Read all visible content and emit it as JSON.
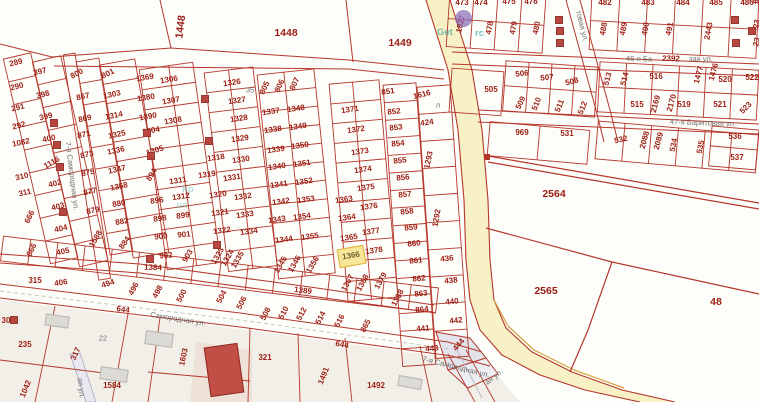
{
  "selected_parcel": {
    "label": "1366",
    "x": 338,
    "y": 247,
    "w": 25,
    "h": 17,
    "rot": -10
  },
  "colors": {
    "parcel_line": "#b5372b",
    "parcel_text": "#9c1d13",
    "street_text": "#707070",
    "road_fill": "#f8f1c6",
    "road_curb": "#d7a33c",
    "lower_area_fill": "#f2efe8",
    "highlight_fill": "#f8e79b",
    "highlight_border": "#dfae33",
    "building_fill": "#b8463e",
    "gray_building_fill": "#dcdad5",
    "gray_lot_fill": "#e3e4eb",
    "watermark_teal": "#209e9e",
    "watermark_purple": "#7b5ea7"
  },
  "watermark": {
    "left": "Get",
    "right": "rc",
    "mid1": "Кр",
    "mid2": "ол"
  },
  "streets": [
    [
      "7-я Самородная ул.",
      72,
      176,
      83
    ],
    [
      "Самородная ул.",
      178,
      319,
      9
    ],
    [
      "7-я Самородная ул.",
      456,
      367,
      14
    ],
    [
      "ая ул.",
      494,
      377,
      -38
    ],
    [
      "ая ул.",
      81,
      388,
      83
    ],
    [
      "товая ул.",
      582,
      26,
      76
    ],
    [
      "46-я Ба",
      639,
      59,
      1
    ],
    [
      "зая ул.",
      701,
      59,
      1
    ],
    [
      "47-я Баритовая ул.",
      703,
      123,
      2
    ],
    [
      "35",
      250,
      90,
      0
    ],
    [
      "л",
      438,
      105,
      0
    ],
    [
      "22",
      103,
      338,
      0
    ]
  ],
  "area_labels": [
    [
      "1448",
      181,
      27,
      -83
    ],
    [
      "1448",
      286,
      33,
      0
    ],
    [
      "1449",
      400,
      43,
      0
    ],
    [
      "2564",
      554,
      194,
      0
    ],
    [
      "2565",
      546,
      291,
      0
    ],
    [
      "48",
      716,
      302,
      0
    ]
  ],
  "road_numbers": [
    [
      "1384",
      153,
      268,
      2
    ],
    [
      "1389",
      303,
      291,
      7
    ],
    [
      "644",
      342,
      345,
      12
    ],
    [
      "644",
      123,
      310,
      8
    ],
    [
      "2392",
      671,
      59,
      1
    ]
  ],
  "parcels": [
    [
      "289",
      16,
      63,
      -14
    ],
    [
      "290",
      17,
      87,
      -14
    ],
    [
      "291",
      18,
      108,
      -14
    ],
    [
      "292",
      19,
      126,
      -14
    ],
    [
      "1082",
      21,
      143,
      -12
    ],
    [
      "310",
      22,
      177,
      -14
    ],
    [
      "311",
      25,
      193,
      -14
    ],
    [
      "666",
      30,
      217,
      -65
    ],
    [
      "866",
      32,
      250,
      -65
    ],
    [
      "397",
      40,
      72,
      -14
    ],
    [
      "398",
      43,
      95,
      -14
    ],
    [
      "399",
      46,
      117,
      -14
    ],
    [
      "400",
      49,
      139,
      -12
    ],
    [
      "1116",
      52,
      163,
      -30
    ],
    [
      "402",
      55,
      184,
      -14
    ],
    [
      "403",
      58,
      207,
      -14
    ],
    [
      "404",
      61,
      229,
      -14
    ],
    [
      "405",
      63,
      252,
      -12
    ],
    [
      "800",
      77,
      74,
      -28
    ],
    [
      "867",
      83,
      97,
      -12
    ],
    [
      "869",
      85,
      119,
      -12
    ],
    [
      "871",
      84,
      135,
      -12
    ],
    [
      "873",
      87,
      155,
      -12
    ],
    [
      "875",
      88,
      173,
      -12
    ],
    [
      "877",
      90,
      192,
      -12
    ],
    [
      "879",
      93,
      211,
      -12
    ],
    [
      "1588",
      96,
      239,
      -60
    ],
    [
      "801",
      108,
      74,
      -25
    ],
    [
      "1303",
      112,
      95,
      -12
    ],
    [
      "1314",
      114,
      116,
      -12
    ],
    [
      "1325",
      117,
      135,
      -12
    ],
    [
      "1336",
      116,
      151,
      -12
    ],
    [
      "1347",
      117,
      170,
      -12
    ],
    [
      "1358",
      119,
      187,
      -12
    ],
    [
      "880",
      119,
      204,
      -10
    ],
    [
      "882",
      122,
      222,
      -10
    ],
    [
      "884",
      125,
      243,
      -55
    ],
    [
      "1369",
      145,
      78,
      -10
    ],
    [
      "1306",
      169,
      80,
      -10
    ],
    [
      "1380",
      146,
      98,
      -10
    ],
    [
      "1307",
      171,
      101,
      -10
    ],
    [
      "1390",
      148,
      117,
      -10
    ],
    [
      "1308",
      173,
      121,
      -10
    ],
    [
      "1304",
      151,
      131,
      -10
    ],
    [
      "1305",
      155,
      151,
      -18
    ],
    [
      "894",
      152,
      175,
      -60
    ],
    [
      "1311",
      178,
      181,
      -8
    ],
    [
      "896",
      157,
      201,
      -8
    ],
    [
      "1312",
      181,
      197,
      -8
    ],
    [
      "898",
      160,
      219,
      -8
    ],
    [
      "899",
      183,
      216,
      -8
    ],
    [
      "900",
      161,
      237,
      -6
    ],
    [
      "901",
      184,
      235,
      -6
    ],
    [
      "902",
      166,
      256,
      -6
    ],
    [
      "903",
      188,
      256,
      -60
    ],
    [
      "1326",
      232,
      83,
      -8
    ],
    [
      "1327",
      237,
      101,
      -8
    ],
    [
      "1328",
      239,
      119,
      -8
    ],
    [
      "1329",
      240,
      139,
      -8
    ],
    [
      "1318",
      216,
      158,
      -8
    ],
    [
      "1330",
      241,
      160,
      -8
    ],
    [
      "1319",
      207,
      175,
      -8
    ],
    [
      "1331",
      232,
      178,
      -8
    ],
    [
      "1320",
      218,
      195,
      -8
    ],
    [
      "1332",
      243,
      197,
      -8
    ],
    [
      "1321",
      220,
      213,
      -8
    ],
    [
      "1333",
      245,
      215,
      -8
    ],
    [
      "1322",
      222,
      231,
      -8
    ],
    [
      "1334",
      249,
      232,
      -8
    ],
    [
      "1323",
      218,
      256,
      -60
    ],
    [
      "1324",
      228,
      258,
      -60
    ],
    [
      "1335",
      238,
      260,
      -60
    ],
    [
      "805",
      265,
      88,
      -65
    ],
    [
      "806",
      280,
      86,
      -65
    ],
    [
      "807",
      295,
      84,
      -65
    ],
    [
      "1337",
      271,
      112,
      -8
    ],
    [
      "1348",
      296,
      109,
      -8
    ],
    [
      "1338",
      273,
      130,
      -8
    ],
    [
      "1349",
      298,
      127,
      -8
    ],
    [
      "1339",
      276,
      150,
      -8
    ],
    [
      "1350",
      300,
      146,
      -8
    ],
    [
      "1340",
      277,
      167,
      -8
    ],
    [
      "1351",
      302,
      164,
      -8
    ],
    [
      "1341",
      279,
      185,
      -8
    ],
    [
      "1352",
      304,
      182,
      -8
    ],
    [
      "1342",
      281,
      202,
      -8
    ],
    [
      "1353",
      306,
      200,
      -8
    ],
    [
      "1343",
      277,
      220,
      -8
    ],
    [
      "1354",
      302,
      217,
      -8
    ],
    [
      "1344",
      284,
      240,
      -8
    ],
    [
      "1355",
      310,
      237,
      -8
    ],
    [
      "1345",
      281,
      265,
      -60
    ],
    [
      "1346",
      295,
      264,
      -60
    ],
    [
      "1356",
      313,
      265,
      -60
    ],
    [
      "1371",
      350,
      110,
      -8
    ],
    [
      "1372",
      356,
      130,
      -8
    ],
    [
      "1373",
      360,
      152,
      -8
    ],
    [
      "1374",
      363,
      170,
      -8
    ],
    [
      "1375",
      366,
      188,
      -8
    ],
    [
      "1363",
      344,
      200,
      -8
    ],
    [
      "1376",
      369,
      207,
      -8
    ],
    [
      "1364",
      347,
      218,
      -8
    ],
    [
      "1365",
      349,
      238,
      -8
    ],
    [
      "1377",
      371,
      232,
      -8
    ],
    [
      "1378",
      374,
      251,
      -8
    ],
    [
      "1367",
      348,
      283,
      -62
    ],
    [
      "1368",
      363,
      283,
      -62
    ],
    [
      "1379",
      381,
      281,
      -62
    ],
    [
      "1388",
      398,
      298,
      -62
    ],
    [
      "851",
      388,
      92,
      -8
    ],
    [
      "852",
      394,
      112,
      -6
    ],
    [
      "853",
      396,
      128,
      -6
    ],
    [
      "854",
      398,
      144,
      -6
    ],
    [
      "855",
      400,
      161,
      -6
    ],
    [
      "856",
      403,
      178,
      -6
    ],
    [
      "857",
      405,
      195,
      -6
    ],
    [
      "858",
      407,
      212,
      -6
    ],
    [
      "859",
      411,
      228,
      -6
    ],
    [
      "860",
      414,
      244,
      -6
    ],
    [
      "861",
      416,
      261,
      -6
    ],
    [
      "862",
      419,
      279,
      -6
    ],
    [
      "863",
      421,
      294,
      -6
    ],
    [
      "864",
      422,
      310,
      -6
    ],
    [
      "441",
      423,
      329,
      -6
    ],
    [
      "443",
      432,
      349,
      -6
    ],
    [
      "1616",
      422,
      95,
      -14
    ],
    [
      "424",
      427,
      123,
      -8
    ],
    [
      "1293",
      429,
      160,
      -78
    ],
    [
      "1292",
      437,
      218,
      -80
    ],
    [
      "436",
      447,
      259,
      -6
    ],
    [
      "438",
      451,
      281,
      -6
    ],
    [
      "440",
      452,
      302,
      -6
    ],
    [
      "442",
      456,
      321,
      -6
    ],
    [
      "444",
      459,
      345,
      -50
    ],
    [
      "473",
      462,
      3,
      0
    ],
    [
      "474",
      481,
      3,
      0
    ],
    [
      "475",
      509,
      2,
      0
    ],
    [
      "476",
      531,
      2,
      0
    ],
    [
      "482",
      605,
      3,
      0
    ],
    [
      "483",
      648,
      3,
      0
    ],
    [
      "484",
      683,
      3,
      0
    ],
    [
      "485",
      716,
      3,
      0
    ],
    [
      "486",
      747,
      3,
      0
    ],
    [
      "48",
      757,
      2,
      0
    ],
    [
      "1827",
      461,
      24,
      -78
    ],
    [
      "478",
      490,
      28,
      -80
    ],
    [
      "479",
      514,
      28,
      -80
    ],
    [
      "480",
      537,
      28,
      -80
    ],
    [
      "488",
      604,
      29,
      -80
    ],
    [
      "489",
      624,
      29,
      -80
    ],
    [
      "490",
      646,
      29,
      -80
    ],
    [
      "491",
      670,
      29,
      -80
    ],
    [
      "2443",
      709,
      31,
      -80
    ],
    [
      "23",
      757,
      24,
      -80
    ],
    [
      "23",
      757,
      42,
      -80
    ],
    [
      "505",
      491,
      90,
      0
    ],
    [
      "506",
      522,
      74,
      -5
    ],
    [
      "507",
      547,
      78,
      -5
    ],
    [
      "508",
      572,
      82,
      -14
    ],
    [
      "509",
      521,
      103,
      -65
    ],
    [
      "510",
      537,
      104,
      -68
    ],
    [
      "511",
      560,
      106,
      -68
    ],
    [
      "512",
      583,
      108,
      -68
    ],
    [
      "513",
      608,
      79,
      -75
    ],
    [
      "514",
      625,
      79,
      -75
    ],
    [
      "516",
      656,
      77,
      0
    ],
    [
      "515",
      637,
      105,
      0
    ],
    [
      "2169",
      656,
      104,
      -75
    ],
    [
      "2170",
      672,
      103,
      -75
    ],
    [
      "1477",
      699,
      75,
      -75
    ],
    [
      "1476",
      714,
      72,
      -75
    ],
    [
      "520",
      725,
      80,
      0
    ],
    [
      "522",
      752,
      78,
      0
    ],
    [
      "519",
      684,
      105,
      0
    ],
    [
      "521",
      720,
      105,
      0
    ],
    [
      "523",
      746,
      108,
      -45
    ],
    [
      "969",
      522,
      133,
      0
    ],
    [
      "531",
      567,
      134,
      0
    ],
    [
      "532",
      621,
      140,
      -12
    ],
    [
      "2088",
      645,
      140,
      -75
    ],
    [
      "2089",
      659,
      141,
      -75
    ],
    [
      "534",
      674,
      145,
      -78
    ],
    [
      "535",
      701,
      147,
      -78
    ],
    [
      "536",
      735,
      137,
      0
    ],
    [
      "537",
      737,
      158,
      0
    ],
    [
      "315",
      35,
      281,
      0
    ],
    [
      "406",
      61,
      283,
      -10
    ],
    [
      "494",
      108,
      284,
      -18
    ],
    [
      "496",
      134,
      289,
      -62
    ],
    [
      "498",
      158,
      292,
      -62
    ],
    [
      "500",
      182,
      296,
      -62
    ],
    [
      "504",
      222,
      297,
      -62
    ],
    [
      "506",
      242,
      303,
      -62
    ],
    [
      "508",
      266,
      314,
      -62
    ],
    [
      "510",
      284,
      313,
      -62
    ],
    [
      "512",
      302,
      314,
      -62
    ],
    [
      "514",
      321,
      318,
      -62
    ],
    [
      "516",
      340,
      321,
      -62
    ],
    [
      "865",
      366,
      326,
      -62
    ],
    [
      "235",
      25,
      345,
      0
    ],
    [
      "317",
      76,
      354,
      -65
    ],
    [
      "1603",
      184,
      357,
      -78
    ],
    [
      "784",
      223,
      369,
      -68
    ],
    [
      "321",
      265,
      358,
      0
    ],
    [
      "1042",
      26,
      389,
      -68
    ],
    [
      "1584",
      112,
      386,
      0
    ],
    [
      "1491",
      324,
      376,
      -68
    ],
    [
      "1492",
      376,
      386,
      0
    ],
    [
      "30",
      6,
      321,
      0
    ]
  ],
  "buildings": {
    "red": [
      [
        201,
        95
      ],
      [
        205,
        137
      ],
      [
        143,
        129
      ],
      [
        147,
        152
      ],
      [
        146,
        255
      ],
      [
        213,
        241
      ],
      [
        555,
        16
      ],
      [
        556,
        27
      ],
      [
        556,
        39
      ],
      [
        731,
        16
      ],
      [
        732,
        39
      ],
      [
        748,
        27
      ],
      [
        50,
        119
      ],
      [
        53,
        141
      ],
      [
        56,
        163
      ],
      [
        59,
        208
      ],
      [
        10,
        316
      ]
    ],
    "big_red": [
      [
        207,
        345,
        32,
        48,
        -8
      ]
    ],
    "gray": [
      [
        45,
        315,
        22,
        10,
        8
      ],
      [
        145,
        332,
        26,
        12,
        8
      ],
      [
        100,
        368,
        26,
        11,
        8
      ],
      [
        398,
        377,
        22,
        9,
        10
      ]
    ]
  }
}
